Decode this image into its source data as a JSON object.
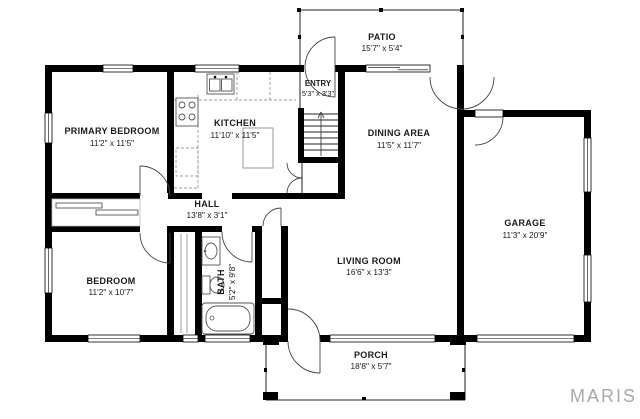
{
  "title": "Floor plan",
  "watermark": "MARIS",
  "rooms": {
    "patio": {
      "name": "PATIO",
      "dims": "15'7\" x 5'4\""
    },
    "entry": {
      "name": "ENTRY",
      "dims": "5'3\" x 3'3\""
    },
    "primary": {
      "name": "PRIMARY BEDROOM",
      "dims": "11'2\" x 11'5\""
    },
    "kitchen": {
      "name": "KITCHEN",
      "dims": "11'10\" x 11'5\""
    },
    "dining": {
      "name": "DINING AREA",
      "dims": "11'5\" x 11'7\""
    },
    "hall": {
      "name": "HALL",
      "dims": "13'8\" x 3'1\""
    },
    "garage": {
      "name": "GARAGE",
      "dims": "11'3\" x 20'9\""
    },
    "bedroom": {
      "name": "BEDROOM",
      "dims": "11'2\" x 10'7\""
    },
    "bath": {
      "name": "BATH",
      "dims": "5'2\" x 9'8\""
    },
    "living": {
      "name": "LIVING ROOM",
      "dims": "16'6\" x 13'3\""
    },
    "porch": {
      "name": "PORCH",
      "dims": "18'8\" x 5'7\""
    }
  },
  "colors": {
    "wall": "#000000",
    "background": "#ffffff",
    "watermark_gray": "#a9a9a9",
    "fixture_line": "#555555"
  }
}
